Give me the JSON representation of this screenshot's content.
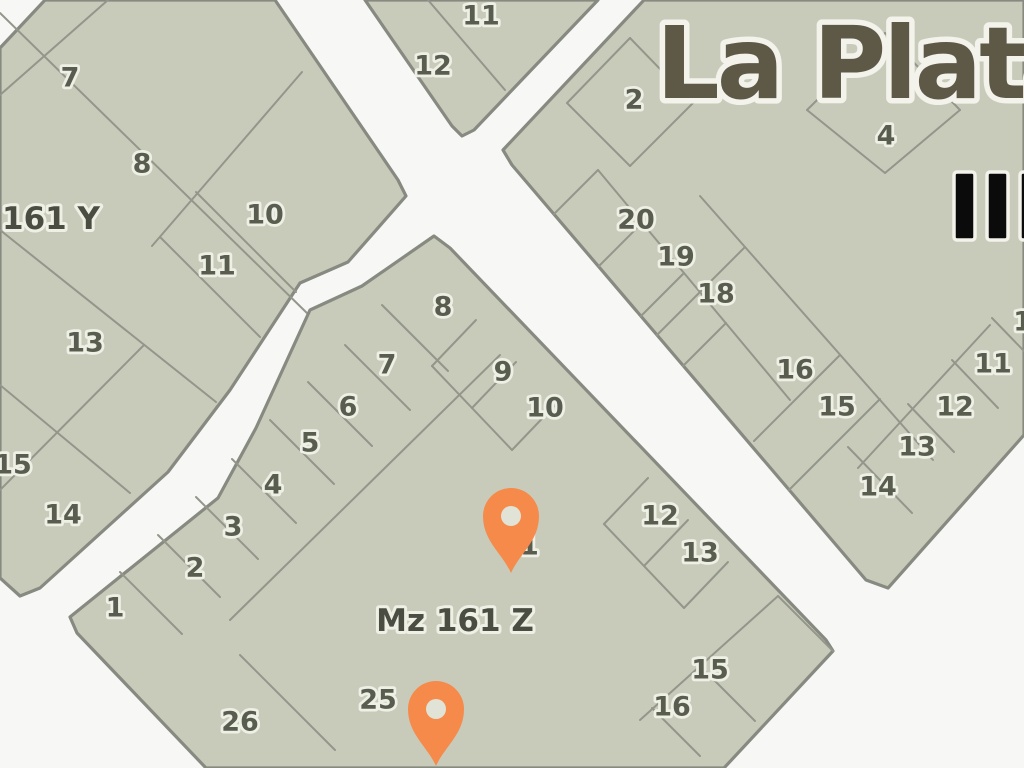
{
  "map": {
    "width": 1024,
    "height": 768,
    "colors": {
      "street_background": "#f7f7f5",
      "block_fill": "#c9cbba",
      "block_stroke": "#878a80",
      "lot_line": "#93968a",
      "lot_number": "#595d4f",
      "label_halo": "#eef0e6",
      "block_label": "#4a4e42",
      "logo_text": "#5e5847",
      "logo_halo": "#f3f2eb",
      "bars": "#0b0b0b",
      "pin": "#f58a4b",
      "pin_hole": "#e0e3d5"
    },
    "blocks": [
      {
        "id": "mz-161-y",
        "label": {
          "text": "161 Y",
          "x": 2,
          "y": 219,
          "anchor": "start",
          "size": 31
        },
        "outline": [
          [
            45,
            0
          ],
          [
            275,
            0
          ],
          [
            398,
            180
          ],
          [
            406,
            196
          ],
          [
            348,
            262
          ],
          [
            300,
            283
          ],
          [
            230,
            390
          ],
          [
            168,
            472
          ],
          [
            40,
            588
          ],
          [
            20,
            596
          ],
          [
            0,
            578
          ],
          [
            0,
            48
          ]
        ],
        "lines": [
          [
            0,
            95,
            108,
            0
          ],
          [
            0,
            13,
            310,
            316
          ],
          [
            302,
            72,
            152,
            246
          ],
          [
            196,
            192,
            296,
            292
          ],
          [
            160,
            237,
            260,
            337
          ],
          [
            0,
            230,
            216,
            402
          ],
          [
            0,
            385,
            130,
            493
          ],
          [
            0,
            490,
            144,
            345
          ]
        ],
        "lots": [
          [
            "7",
            70,
            78
          ],
          [
            "8",
            142,
            164
          ],
          [
            "10",
            265,
            215
          ],
          [
            "11",
            217,
            266
          ],
          [
            "13",
            85,
            343
          ],
          [
            "15",
            13,
            465
          ],
          [
            "14",
            63,
            515
          ]
        ]
      },
      {
        "id": "top-block",
        "outline": [
          [
            365,
            0
          ],
          [
            598,
            0
          ],
          [
            474,
            130
          ],
          [
            462,
            136
          ],
          [
            452,
            126
          ]
        ],
        "lines": [
          [
            428,
            0,
            505,
            90
          ]
        ],
        "lots": [
          [
            "11",
            481,
            16
          ],
          [
            "12",
            433,
            66
          ]
        ]
      },
      {
        "id": "mz-161-z",
        "label": {
          "text": "Mz 161 Z",
          "x": 455,
          "y": 621,
          "anchor": "middle",
          "size": 31
        },
        "outline": [
          [
            434,
            236
          ],
          [
            450,
            248
          ],
          [
            826,
            640
          ],
          [
            833,
            651
          ],
          [
            724,
            768
          ],
          [
            206,
            768
          ],
          [
            77,
            633
          ],
          [
            70,
            617
          ],
          [
            218,
            498
          ],
          [
            256,
            428
          ],
          [
            310,
            310
          ],
          [
            362,
            286
          ]
        ],
        "lines": [
          [
            500,
            355,
            230,
            620
          ],
          [
            382,
            305,
            448,
            371
          ],
          [
            345,
            345,
            410,
            410
          ],
          [
            308,
            382,
            372,
            446
          ],
          [
            270,
            420,
            334,
            484
          ],
          [
            232,
            459,
            296,
            523
          ],
          [
            196,
            497,
            258,
            559
          ],
          [
            158,
            535,
            220,
            597
          ],
          [
            120,
            572,
            182,
            634
          ],
          [
            476,
            320,
            432,
            366
          ],
          [
            516,
            362,
            472,
            408
          ],
          [
            556,
            404,
            512,
            450
          ],
          [
            432,
            366,
            512,
            450
          ],
          [
            648,
            478,
            604,
            524
          ],
          [
            688,
            520,
            644,
            566
          ],
          [
            728,
            562,
            684,
            608
          ],
          [
            604,
            524,
            684,
            608
          ],
          [
            778,
            596,
            833,
            651
          ],
          [
            778,
            596,
            640,
            720
          ],
          [
            700,
            666,
            755,
            721
          ],
          [
            652,
            708,
            700,
            756
          ],
          [
            240,
            655,
            335,
            750
          ]
        ],
        "lots": [
          [
            "8",
            443,
            307
          ],
          [
            "7",
            387,
            365
          ],
          [
            "6",
            348,
            407
          ],
          [
            "5",
            310,
            443
          ],
          [
            "4",
            273,
            485
          ],
          [
            "3",
            233,
            527
          ],
          [
            "2",
            195,
            568
          ],
          [
            "1",
            115,
            608
          ],
          [
            "9",
            503,
            372
          ],
          [
            "10",
            545,
            408
          ],
          [
            "12",
            660,
            516
          ],
          [
            "13",
            700,
            553
          ],
          [
            "15",
            710,
            670
          ],
          [
            "16",
            672,
            707
          ],
          [
            "25",
            378,
            700
          ],
          [
            "26",
            240,
            722
          ],
          [
            "11",
            520,
            546
          ]
        ]
      },
      {
        "id": "right-block",
        "outline": [
          [
            644,
            0
          ],
          [
            1024,
            0
          ],
          [
            1024,
            435
          ],
          [
            888,
            588
          ],
          [
            866,
            580
          ],
          [
            512,
            165
          ],
          [
            503,
            150
          ]
        ],
        "lines": [
          [
            598,
            170,
            790,
            400
          ],
          [
            598,
            170,
            554,
            214
          ],
          [
            642,
            223,
            599,
            266
          ],
          [
            684,
            273,
            641,
            316
          ],
          [
            726,
            323,
            683,
            366
          ],
          [
            700,
            196,
            933,
            460
          ],
          [
            745,
            247,
            657,
            335
          ],
          [
            840,
            355,
            754,
            441
          ],
          [
            880,
            399,
            789,
            490
          ],
          [
            848,
            447,
            912,
            513
          ],
          [
            952,
            360,
            998,
            408
          ],
          [
            908,
            404,
            954,
            452
          ],
          [
            992,
            318,
            1024,
            351
          ],
          [
            990,
            325,
            858,
            468
          ],
          [
            630,
            38,
            693,
            103
          ],
          [
            693,
            103,
            630,
            166
          ],
          [
            630,
            166,
            567,
            103
          ],
          [
            567,
            103,
            630,
            38
          ],
          [
            885,
            33,
            960,
            110
          ],
          [
            960,
            110,
            885,
            173
          ],
          [
            885,
            173,
            807,
            110
          ],
          [
            807,
            110,
            885,
            33
          ]
        ],
        "lots": [
          [
            "2",
            634,
            100
          ],
          [
            "4",
            886,
            136
          ],
          [
            "20",
            636,
            220
          ],
          [
            "19",
            676,
            257
          ],
          [
            "18",
            716,
            294
          ],
          [
            "16",
            795,
            370
          ],
          [
            "15",
            837,
            407
          ],
          [
            "13",
            917,
            447
          ],
          [
            "14",
            878,
            487
          ],
          [
            "11",
            993,
            364
          ],
          [
            "12",
            955,
            407
          ],
          [
            "10",
            1032,
            322
          ]
        ]
      }
    ],
    "logo": {
      "text": "La Plata",
      "x": 656,
      "y": 98,
      "size": 100
    },
    "bars": {
      "count": 3,
      "x": 954,
      "y": 172,
      "width": 21,
      "gap": 12,
      "height": 68
    },
    "pins": [
      {
        "tip_x": 511,
        "tip_y": 573,
        "head_r": 28,
        "hole_r": 10
      },
      {
        "tip_x": 436,
        "tip_y": 766,
        "head_r": 28,
        "hole_r": 10
      }
    ]
  }
}
